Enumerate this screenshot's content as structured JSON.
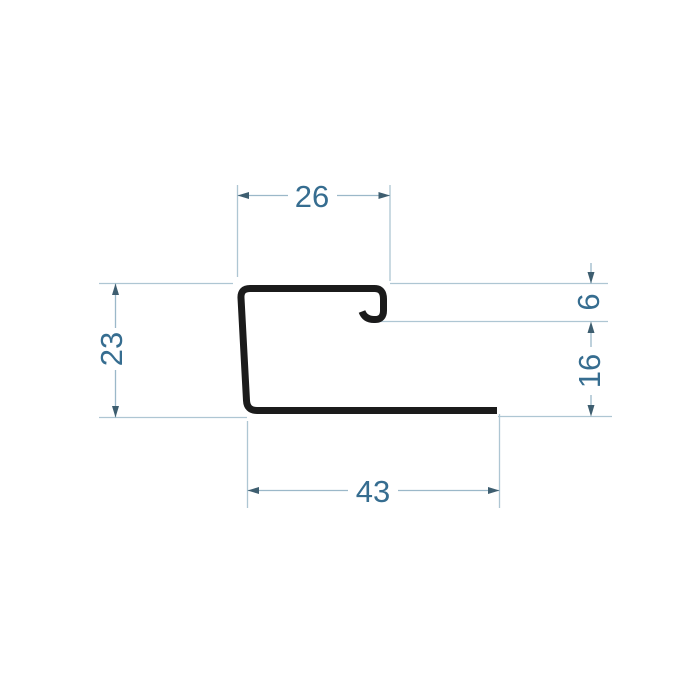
{
  "diagram": {
    "kind": "profile-cross-section-technical-drawing",
    "dimensions": {
      "top_width": "26",
      "hook_height": "6",
      "right_height": "16",
      "left_height": "23",
      "bottom_width": "43"
    },
    "colors": {
      "profile_outline": "#1b1b1b",
      "extension_line": "#aec6d3",
      "dimension_line": "#9bb8c9",
      "arrowhead": "#3e5e70",
      "dimension_text": "#366d90",
      "background": "#ffffff"
    }
  }
}
